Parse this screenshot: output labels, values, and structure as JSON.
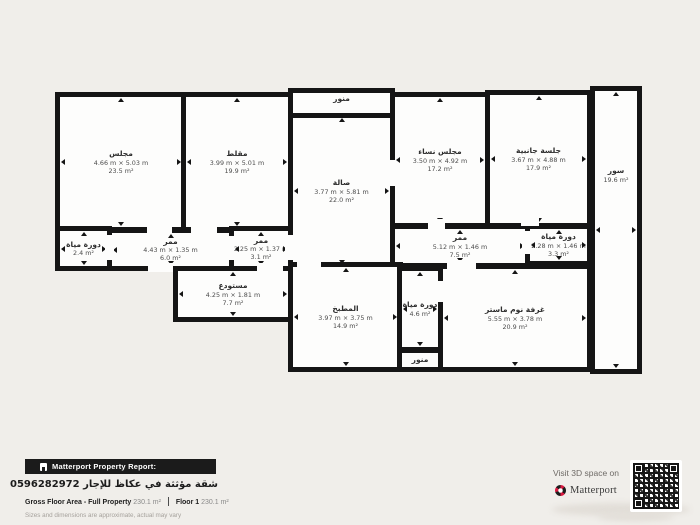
{
  "colors": {
    "background": "#f0eeea",
    "wall": "#151515",
    "room_fill": "#fdfdfc",
    "bar_bg": "#1b1b1b",
    "accent_red": "#d81a41"
  },
  "plan": {
    "rooms": [
      {
        "id": "majlis",
        "label": "مجلس",
        "dims": "4.66 m × 5.03 m",
        "area": "23.5 m²",
        "rect": [
          55,
          92,
          132,
          140
        ]
      },
      {
        "id": "maglat",
        "label": "مقلط",
        "dims": "3.99 m × 5.01 m",
        "area": "19.9 m²",
        "rect": [
          181,
          92,
          112,
          140
        ]
      },
      {
        "id": "menawar-top",
        "label": "منور",
        "dims": null,
        "area": null,
        "rect": [
          288,
          88,
          107,
          30
        ],
        "shaft": true,
        "label_pos": "top"
      },
      {
        "id": "sala",
        "label": "صالة",
        "dims": "3.77 m × 5.81 m",
        "area": "22.0 m²",
        "rect": [
          288,
          112,
          107,
          158
        ]
      },
      {
        "id": "majlis-nisa",
        "label": "مجلس نساء",
        "dims": "3.50 m × 4.92 m",
        "area": "17.2 m²",
        "rect": [
          390,
          92,
          100,
          136
        ]
      },
      {
        "id": "jalsa-janbia",
        "label": "جلسة جانبية",
        "dims": "3.67 m × 4.88 m",
        "area": "17.9 m²",
        "rect": [
          485,
          90,
          107,
          138
        ]
      },
      {
        "id": "soor",
        "label": "سور",
        "dims": null,
        "area": "19.6 m²",
        "rect": [
          590,
          86,
          52,
          288
        ],
        "label_dy": -55
      },
      {
        "id": "bathroom-24",
        "label": "دورة مياة",
        "dims": null,
        "area": "2.4 m²",
        "rect": [
          55,
          226,
          57,
          45
        ]
      },
      {
        "id": "corridor-60",
        "label": "ممر",
        "dims": "4.43 m × 1.35 m",
        "area": "6.0 m²",
        "rect": [
          107,
          228,
          127,
          43
        ]
      },
      {
        "id": "corridor-31",
        "label": "ممر",
        "dims": "2.25 m × 1.37 m",
        "area": "3.1 m²",
        "rect": [
          229,
          226,
          64,
          45
        ]
      },
      {
        "id": "corridor-75",
        "label": "ممر",
        "dims": "5.12 m × 1.46 m",
        "area": "7.5 m²",
        "rect": [
          390,
          224,
          140,
          44
        ]
      },
      {
        "id": "bathroom-33",
        "label": "دورة مياة",
        "dims": "2.28 m × 1.46 m",
        "area": "3.3 m²",
        "rect": [
          525,
          224,
          67,
          42
        ]
      },
      {
        "id": "storage",
        "label": "مستودع",
        "dims": "4.25 m × 1.81 m",
        "area": "7.7 m²",
        "rect": [
          173,
          266,
          120,
          56
        ]
      },
      {
        "id": "kitchen",
        "label": "المطبخ",
        "dims": "3.97 m × 3.75 m",
        "area": "14.9 m²",
        "rect": [
          288,
          262,
          115,
          110
        ]
      },
      {
        "id": "bathroom-46",
        "label": "دورة مياة",
        "dims": null,
        "area": "4.6 m²",
        "rect": [
          397,
          266,
          46,
          86
        ]
      },
      {
        "id": "menawar-bottom",
        "label": "منور",
        "dims": null,
        "area": null,
        "rect": [
          397,
          348,
          46,
          24
        ],
        "shaft": true
      },
      {
        "id": "master-bedroom",
        "label": "غرفة نوم ماستر",
        "dims": "5.55 m × 3.78 m",
        "area": "20.9 m²",
        "rect": [
          438,
          264,
          154,
          108
        ]
      }
    ],
    "openings": [
      {
        "rect": [
          147,
          224,
          25,
          10
        ]
      },
      {
        "rect": [
          191,
          224,
          26,
          10
        ]
      },
      {
        "rect": [
          148,
          263,
          25,
          9
        ]
      },
      {
        "rect": [
          257,
          263,
          26,
          9
        ]
      },
      {
        "rect": [
          105,
          235,
          9,
          25
        ]
      },
      {
        "rect": [
          285,
          235,
          9,
          25
        ]
      },
      {
        "rect": [
          224,
          236,
          10,
          24
        ]
      },
      {
        "rect": [
          297,
          259,
          24,
          9
        ]
      },
      {
        "rect": [
          387,
          160,
          9,
          26
        ]
      },
      {
        "rect": [
          428,
          219,
          17,
          10
        ]
      },
      {
        "rect": [
          521,
          216,
          18,
          10
        ]
      },
      {
        "rect": [
          522,
          231,
          9,
          23
        ]
      },
      {
        "rect": [
          447,
          260,
          29,
          9
        ]
      },
      {
        "rect": [
          437,
          281,
          8,
          21
        ]
      }
    ]
  },
  "footer": {
    "report_bar_label": "Matterport Property Report:",
    "listing_title": "شقة مؤثثة في عكاظ للإجار 0596282972",
    "gfa_label": "Gross Floor Area - Full Property",
    "gfa_value": "230.1 m²",
    "floor_label": "Floor 1",
    "floor_value": "230.1 m²",
    "disclaimer": "Sizes and dimensions are approximate, actual may vary"
  },
  "cta": {
    "visit_line": "Visit 3D space on",
    "brand": "Matterport"
  }
}
